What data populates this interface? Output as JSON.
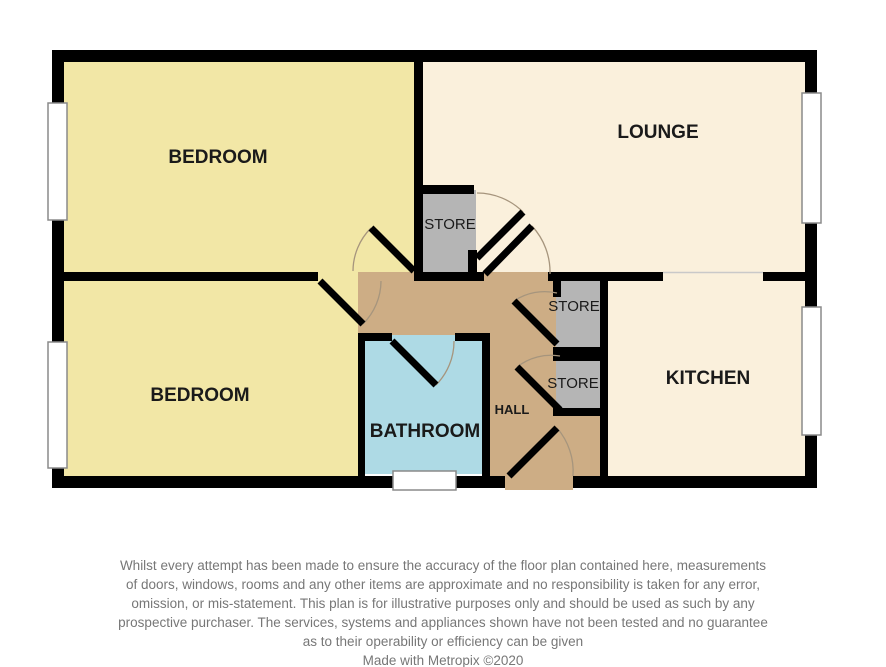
{
  "plan": {
    "rooms": {
      "bedroom1": {
        "label": "BEDROOM"
      },
      "bedroom2": {
        "label": "BEDROOM"
      },
      "lounge": {
        "label": "LOUNGE"
      },
      "kitchen": {
        "label": "KITCHEN"
      },
      "bathroom": {
        "label": "BATHROOM"
      },
      "hall": {
        "label": "HALL"
      },
      "store1": {
        "label": "STORE"
      },
      "store2": {
        "label": "STORE"
      },
      "store3": {
        "label": "STORE"
      }
    },
    "colors": {
      "background": "#FFFFFF",
      "wall": "#000000",
      "bedroom_floor": "#F2E7A6",
      "lounge_floor": "#FAF0DC",
      "kitchen_floor": "#FAF0DC",
      "hall_floor": "#CDAD85",
      "bathroom_floor": "#AEDAE5",
      "store_floor": "#B5B5B5",
      "window_fill": "#FFFFFF",
      "window_frame": "#8A8A8A",
      "door_leaf": "#000000",
      "door_arc": "#A6957D",
      "opening_line": "#C9C9C9",
      "label_text": "#1A1A1A",
      "disclaimer_text": "#777777"
    }
  },
  "footer": {
    "disclaimer_lines": [
      "Whilst every attempt has been made to ensure the accuracy of the floor plan contained here, measurements",
      "of doors, windows, rooms and any other items are approximate and no responsibility is taken for any error,",
      "omission, or mis-statement. This plan is for illustrative purposes only and should be used as such by any",
      "prospective purchaser. The services, systems and appliances shown have not been tested and no guarantee",
      "as to their operability or efficiency can be given"
    ],
    "credit": "Made with Metropix ©2020"
  }
}
